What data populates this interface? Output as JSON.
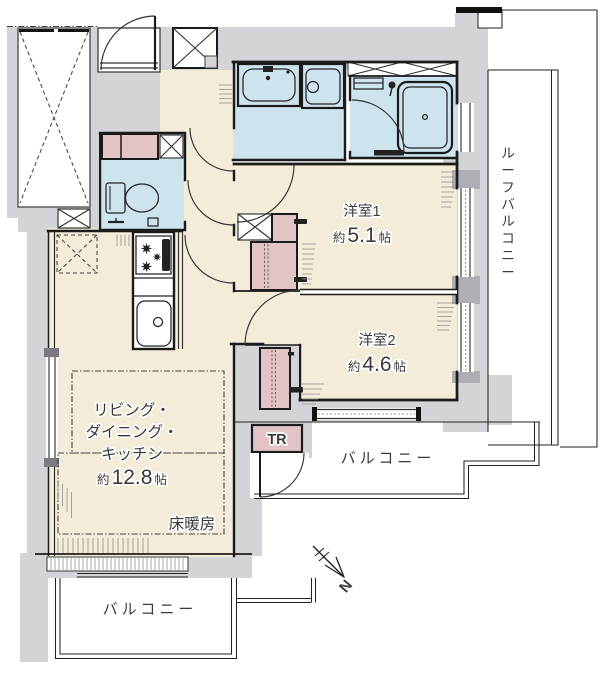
{
  "rooms": {
    "room1": {
      "name": "洋室1",
      "approx": "約",
      "size": "5.1",
      "unit": "帖"
    },
    "room2": {
      "name": "洋室2",
      "approx": "約",
      "size": "4.6",
      "unit": "帖"
    },
    "ldk": {
      "line1": "リビング・",
      "line2": "ダイニング・",
      "line3": "キッチン",
      "approx": "約",
      "size": "12.8",
      "unit": "帖",
      "floor_heating": "床暖房"
    },
    "trunk_room": "TR"
  },
  "balconies": {
    "right": "バルコニー",
    "bottom": "バルコニー",
    "roof": {
      "label": "ルーフバルコニー",
      "chars": [
        "ル",
        "ー",
        "フ",
        "バ",
        "ル",
        "コ",
        "ニ",
        "ー"
      ]
    }
  },
  "compass": {
    "north": "N"
  },
  "colors": {
    "wall_gray": "#d3d4d8",
    "room_beige": "#f2ecd8",
    "wet_blue": "#cde4ef",
    "closet_pink": "#e2c4c7",
    "outline": "#1b1b1b",
    "window_nub": "#aeafb5"
  }
}
